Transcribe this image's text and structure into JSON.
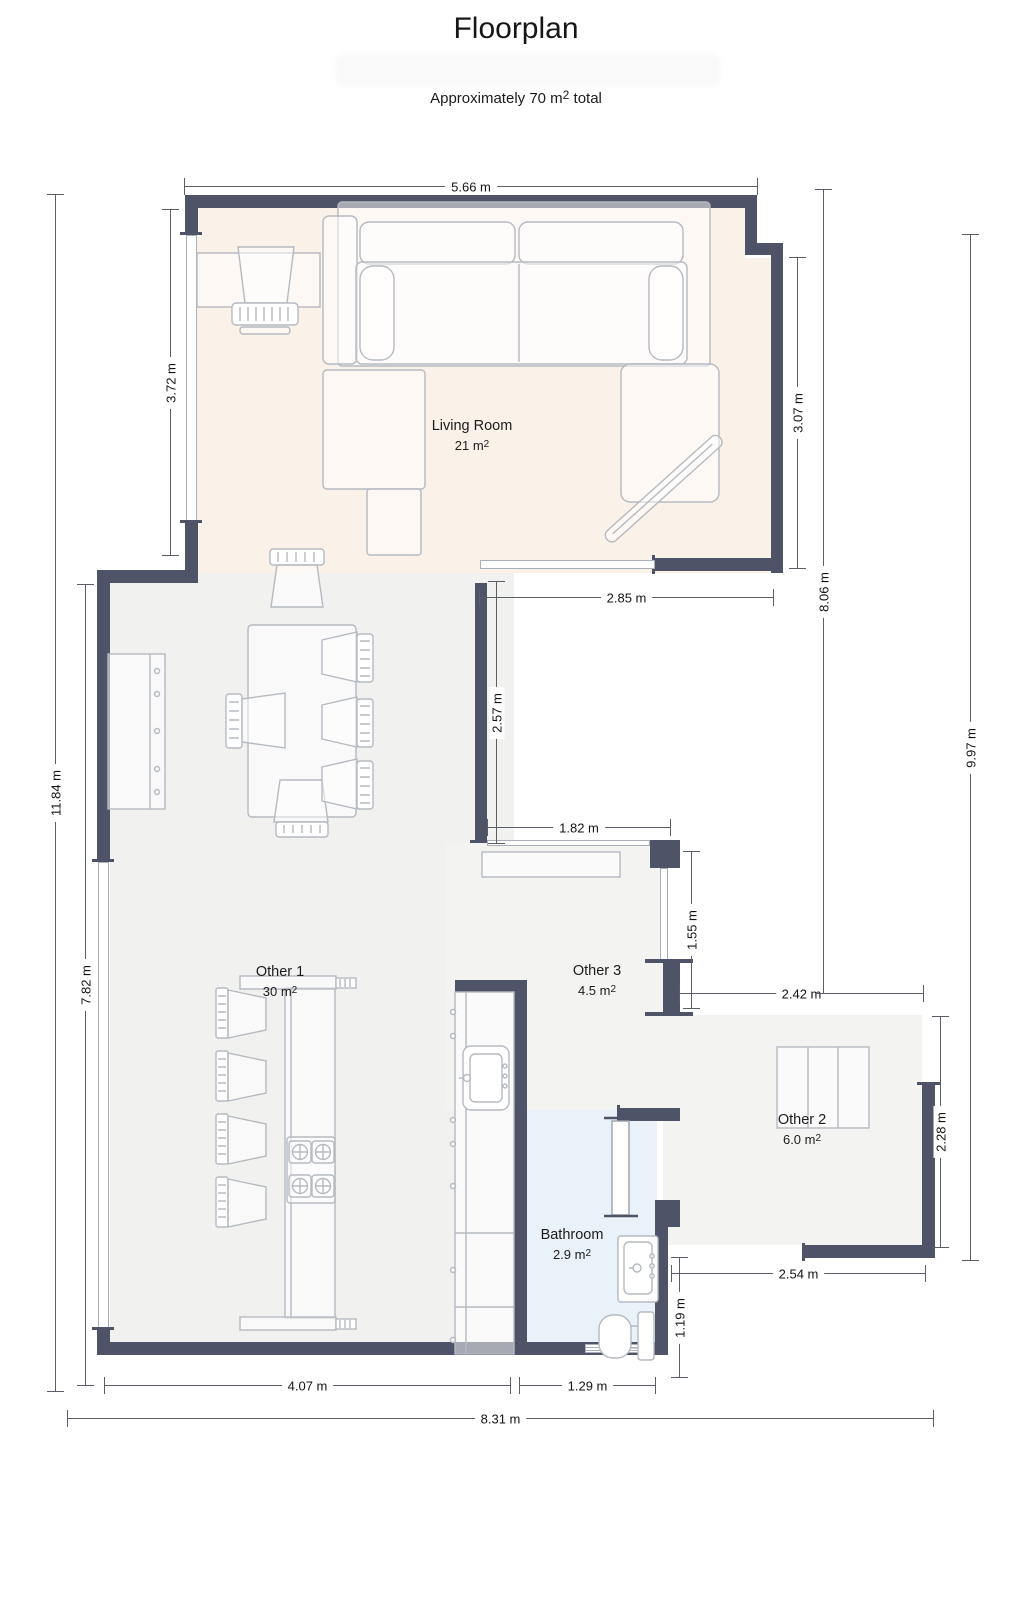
{
  "title": "Floorplan",
  "subtitle": {
    "prefix": "Approximately 70 m",
    "sup": "2",
    "suffix": " total"
  },
  "rooms": [
    {
      "id": "living-room",
      "name": "Living Room",
      "area_prefix": "21 m",
      "area_sup": "2"
    },
    {
      "id": "other-1",
      "name": "Other 1",
      "area_prefix": "30 m",
      "area_sup": "2"
    },
    {
      "id": "other-3",
      "name": "Other 3",
      "area_prefix": "4.5 m",
      "area_sup": "2"
    },
    {
      "id": "other-2",
      "name": "Other 2",
      "area_prefix": "6.0 m",
      "area_sup": "2"
    },
    {
      "id": "bathroom",
      "name": "Bathroom",
      "area_prefix": "2.9 m",
      "area_sup": "2"
    }
  ],
  "dimensions": {
    "top_width": "5.66 m",
    "living_left": "3.72 m",
    "living_right": "3.07 m",
    "living_bottom_opening": "2.85 m",
    "mid_wall": "2.57 m",
    "right_inner": "8.06 m",
    "right_outer": "9.97 m",
    "left_outer": "11.84 m",
    "left_inner": "7.82 m",
    "hall_top": "1.82 m",
    "hall_right": "1.55 m",
    "other2_top": "2.42 m",
    "other2_right": "2.28 m",
    "other2_bottom": "2.54 m",
    "bathroom_right": "1.19 m",
    "bottom_left": "4.07 m",
    "bottom_bath": "1.29 m",
    "bottom_total": "8.31 m"
  },
  "colors": {
    "wall": "#4e5367",
    "living_floor": "#faf1e8",
    "floor_gray": "#f1f2f0",
    "floor_gray_light": "#f3f4f2",
    "bathroom_floor": "#e9f1f9",
    "dim_line": "#5a5f67",
    "furniture_stroke": "#b5bac1"
  }
}
